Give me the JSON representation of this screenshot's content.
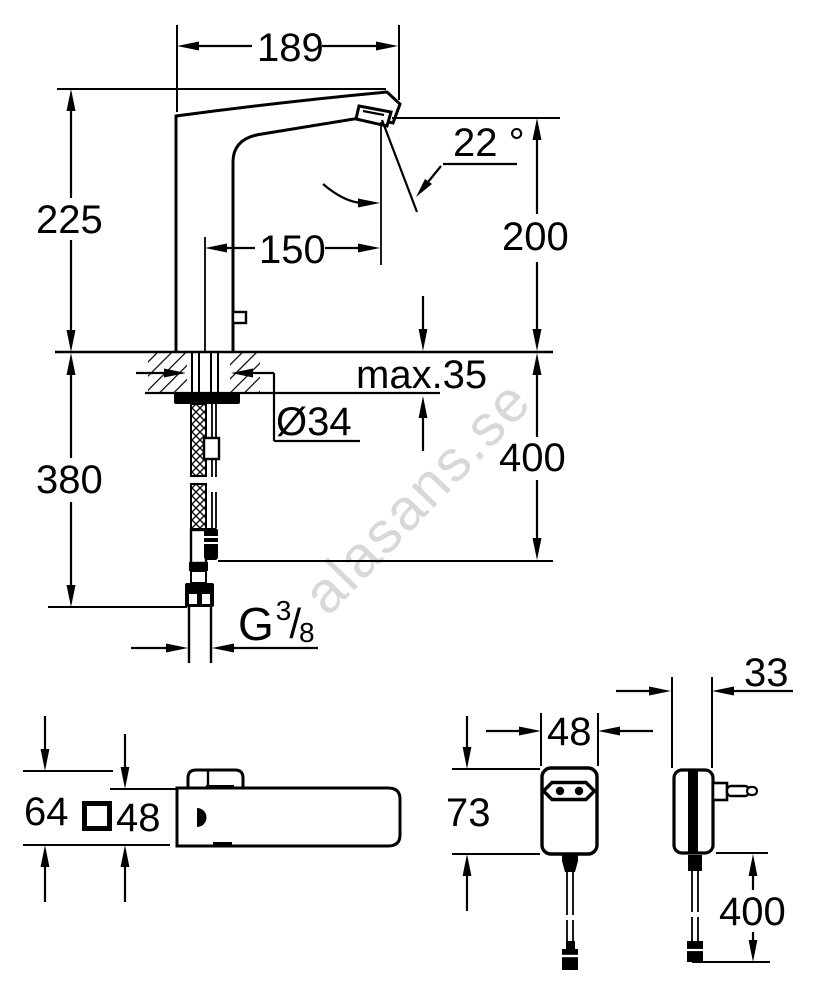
{
  "watermark": {
    "text": "alasans.se",
    "color": "#d8d8d8"
  },
  "drawing": {
    "kind": "technical dimension drawing",
    "subject": "electronic sensor basin mixer with plug-in power supply",
    "line_color": "#000000",
    "background": "#ffffff"
  },
  "views": {
    "faucet_side": {
      "name": "faucet side elevation",
      "dims": {
        "spout_width": "189",
        "height_above_deck": "225",
        "spout_reach": "150",
        "outlet_height": "200",
        "spray_angle": "22 °",
        "deck_thickness": "max.35",
        "hole_diameter": "Ø34",
        "hose_below_deck": "380",
        "cable_below_deck": "400",
        "thread": {
          "letter": "G",
          "numerator": "3",
          "slash": "/",
          "denominator": "8"
        }
      }
    },
    "faucet_top": {
      "name": "faucet plan view",
      "dims": {
        "overall_height": "64",
        "square_body": "48"
      }
    },
    "psu_front": {
      "name": "power supply front view",
      "dims": {
        "width": "48",
        "height": "73"
      }
    },
    "psu_side": {
      "name": "power supply side view",
      "dims": {
        "depth": "33",
        "cable_length": "400"
      }
    }
  }
}
